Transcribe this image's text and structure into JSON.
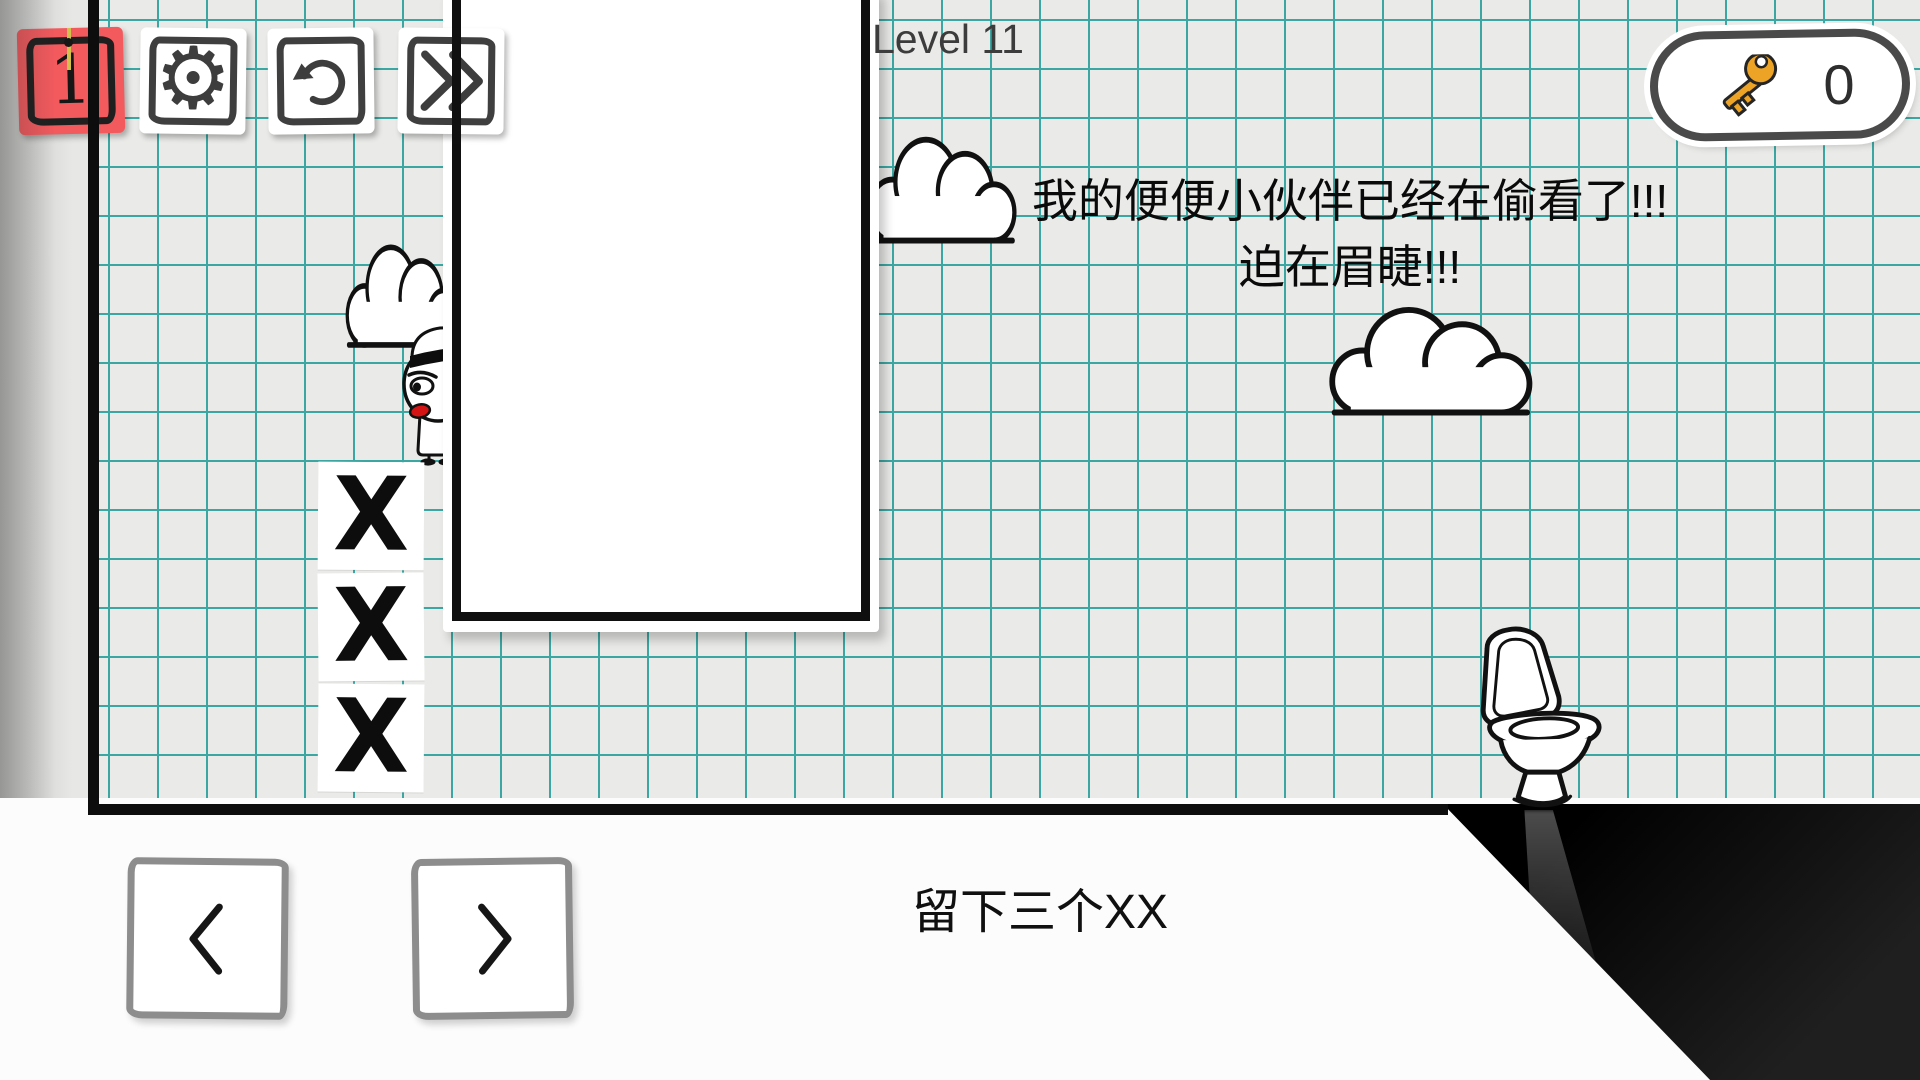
{
  "hud": {
    "level_label": "Level 11",
    "stage_button": {
      "label": "1"
    },
    "settings_button": {
      "icon_char": "⚙"
    },
    "key_counter": {
      "count": "0"
    }
  },
  "speech": {
    "line1": "我的便便小伙伴已经在偷看了!!!",
    "line2": "迫在眉睫!!!"
  },
  "level": {
    "blocks": [
      {
        "symbol": "X"
      },
      {
        "symbol": "X"
      },
      {
        "symbol": "X"
      }
    ]
  },
  "footer": {
    "caption": "留下三个XX"
  },
  "icons": {
    "settings": "gear",
    "restart": "circular-arrow",
    "skip": "double-chevron-right",
    "previous": "chevron-left",
    "next": "chevron-right",
    "keys": "key",
    "decor": [
      "cloud",
      "toilet",
      "captain-character"
    ]
  },
  "colors": {
    "accent_red": "#f25a5e",
    "grid_line": "#3aa7a3",
    "paper": "#eaeae8",
    "key_gold": "#eda426",
    "ink": "#111111"
  }
}
